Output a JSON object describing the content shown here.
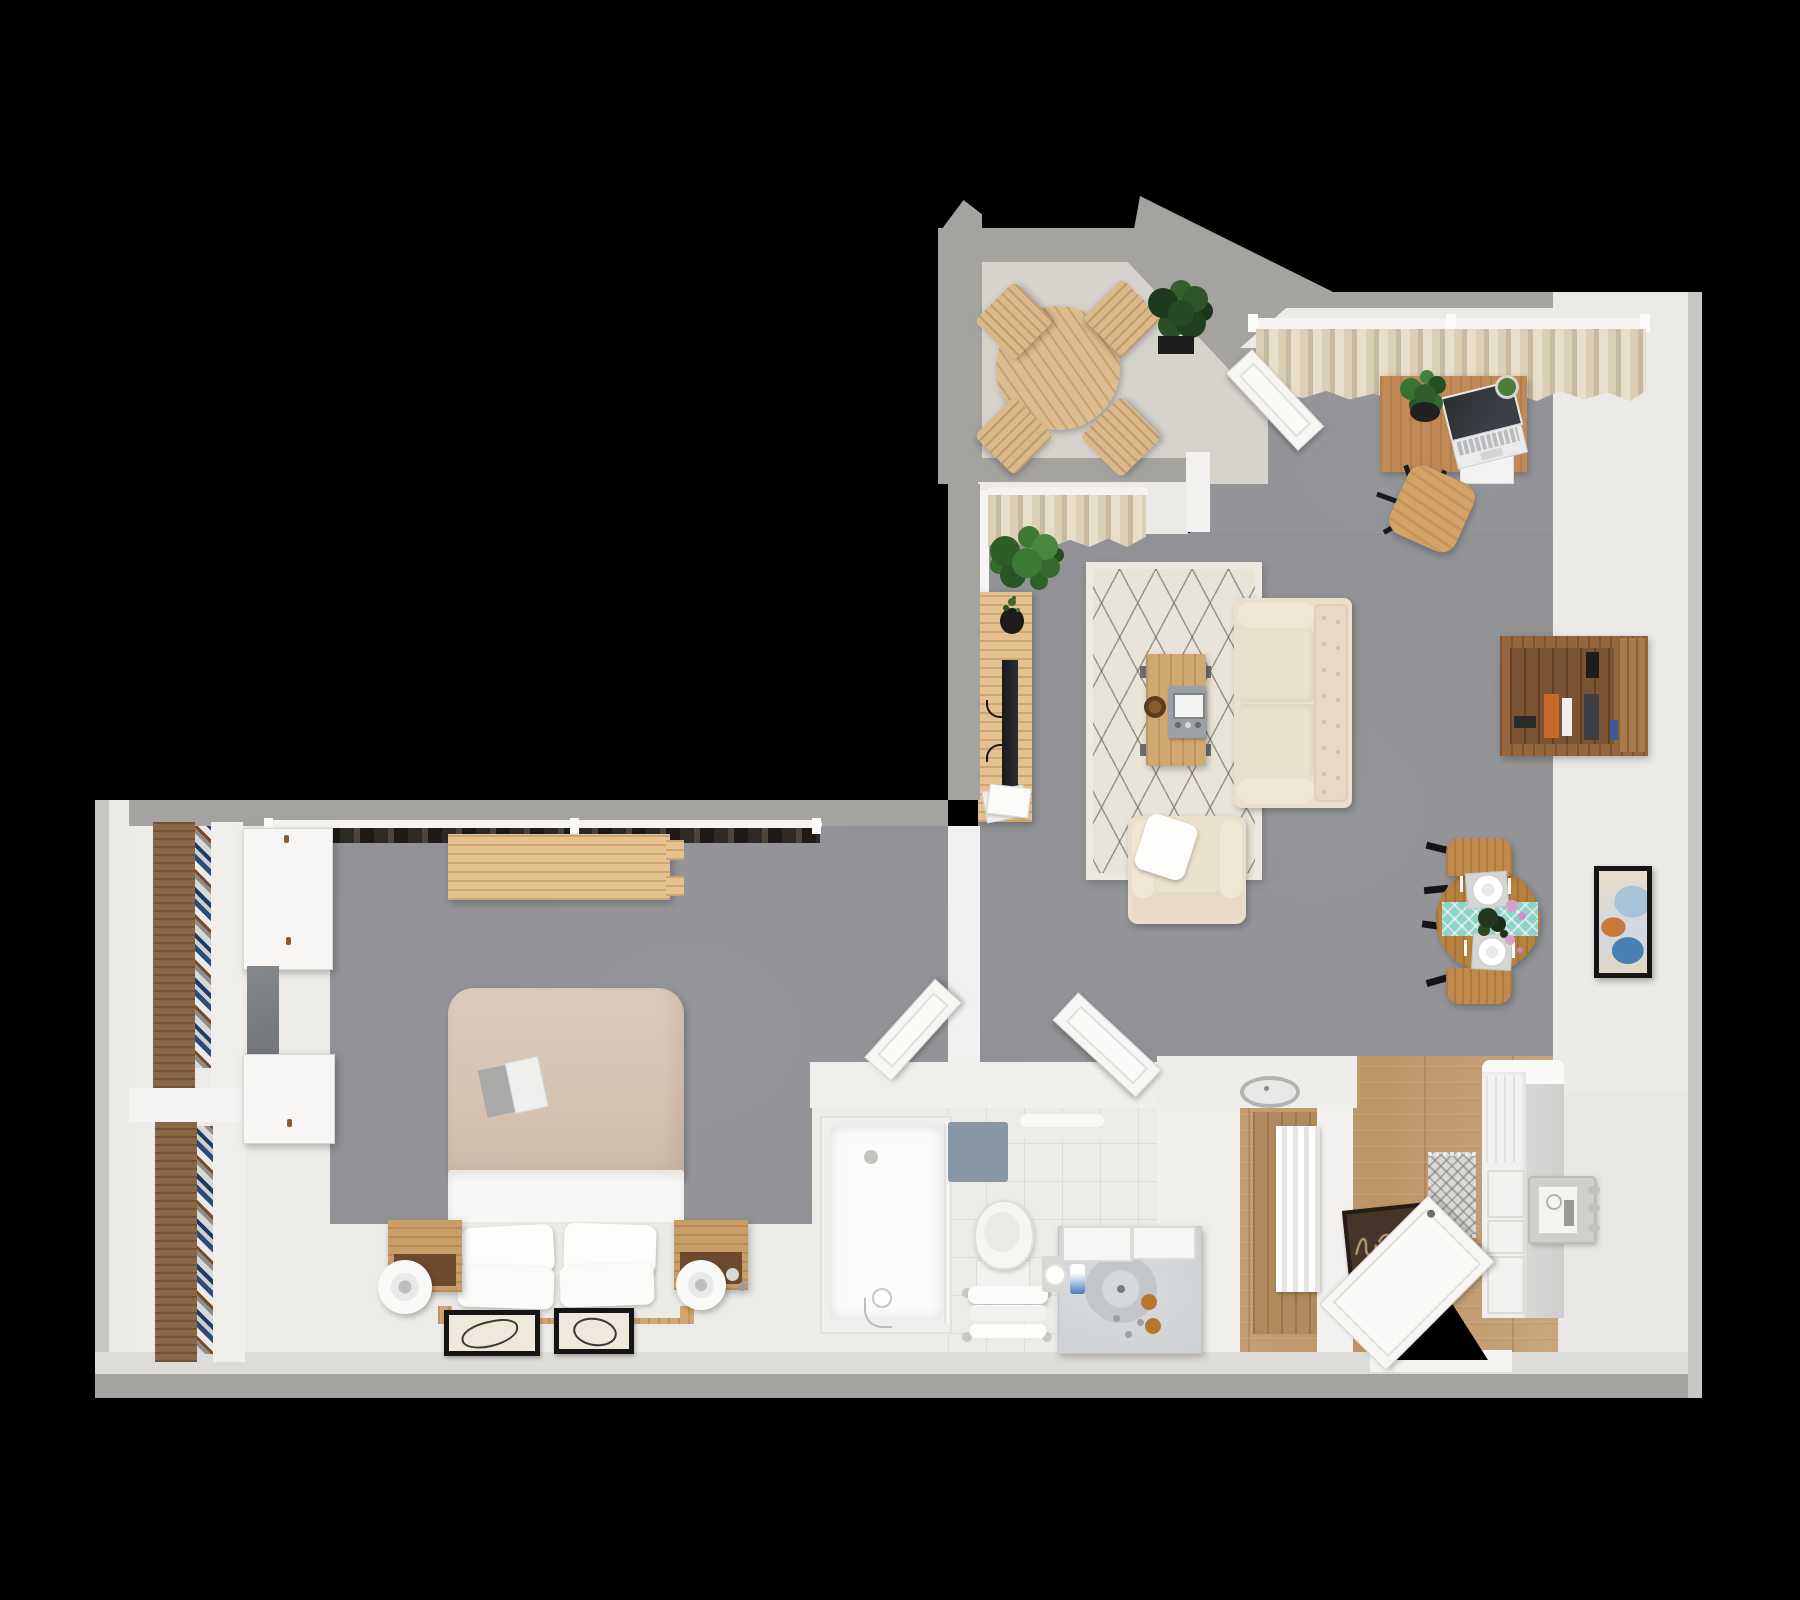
{
  "scene": {
    "type": "3d-floorplan-top-view-render",
    "background_color": "#000000",
    "rooms": [
      {
        "id": "balcony",
        "label": "Balcony",
        "floor_color": "#d6d3cd",
        "furniture": [
          "round slatted outdoor table",
          "four slatted folding chairs",
          "potted plant"
        ]
      },
      {
        "id": "living-room",
        "label": "Living room",
        "floor_color": "#8f9194",
        "furniture": [
          "desk with laptop, plant and cactus",
          "wooden office chair",
          "beige window curtains",
          "cream area rug with diamond lattice",
          "wooden coffee table with gray tray and bowl",
          "cream loveseat sofa",
          "cream armchair with white pillow",
          "wooden tv console with tv, plant and magazines",
          "fiddle-leaf plant",
          "wall-mounted bookshelf with books",
          "framed wall art",
          "round dining table with teal runner, two place settings and flowers",
          "two wooden dining chairs",
          "open french door to balcony"
        ]
      },
      {
        "id": "bedroom",
        "label": "Bedroom",
        "floor_colors": [
          "#8f9194",
          "#edebe7"
        ],
        "furniture": [
          "double bed with tan duvet and four pillows",
          "book on duvet",
          "wood platform headboard",
          "two wooden nightstands",
          "two white drum lamps",
          "two framed line-art prints on floor",
          "wall shelf above bed",
          "dark window curtain along top wall",
          "closet shelving with folded linens",
          "two white wardrobe cabinets",
          "gray panel"
        ]
      },
      {
        "id": "bathroom",
        "label": "Bathroom",
        "floor_color": "#ecebe7",
        "furniture": [
          "walk-in shower with glass panel and hand shower",
          "toilet",
          "bench with folded towels",
          "marble vanity with round sink and mirror cabinet",
          "blue-gray bath mat",
          "hanging towels",
          "toilet paper holder",
          "amber soap bottles",
          "toothbrush cup"
        ]
      },
      {
        "id": "entry-kitchen",
        "label": "Entry / Kitchen",
        "floor_color": "#c7a176",
        "furniture": [
          "open entry door",
          "dark welcome doormat with cursive script",
          "small runner rug",
          "tall white cabinet",
          "side-mounted utility sink with faucet handles",
          "hall closet with white curtain",
          "metal ring detail on half wall"
        ]
      }
    ]
  },
  "palette": {
    "background": "#000000",
    "outer_wall": "#a5a3a0",
    "inner_wall": "#eceae6",
    "living_floor": "#8f9194",
    "balcony_floor": "#d6d3cd",
    "bedroom_floor_south": "#edebe7",
    "bathroom_tile": "#ecebe7",
    "kitchen_wood": "#c7a176",
    "rug_cream": "#e9e4d9",
    "sofa_cream": "#eadfca",
    "wood_light": "#e4c18e",
    "wood_mid": "#c08a57",
    "wood_dark": "#8a6847",
    "runner_teal": "#8fd2c7",
    "plant_green": "#2f5d2b",
    "curtain_beige": "#d6c9ae",
    "doormat_brown": "#453528"
  }
}
